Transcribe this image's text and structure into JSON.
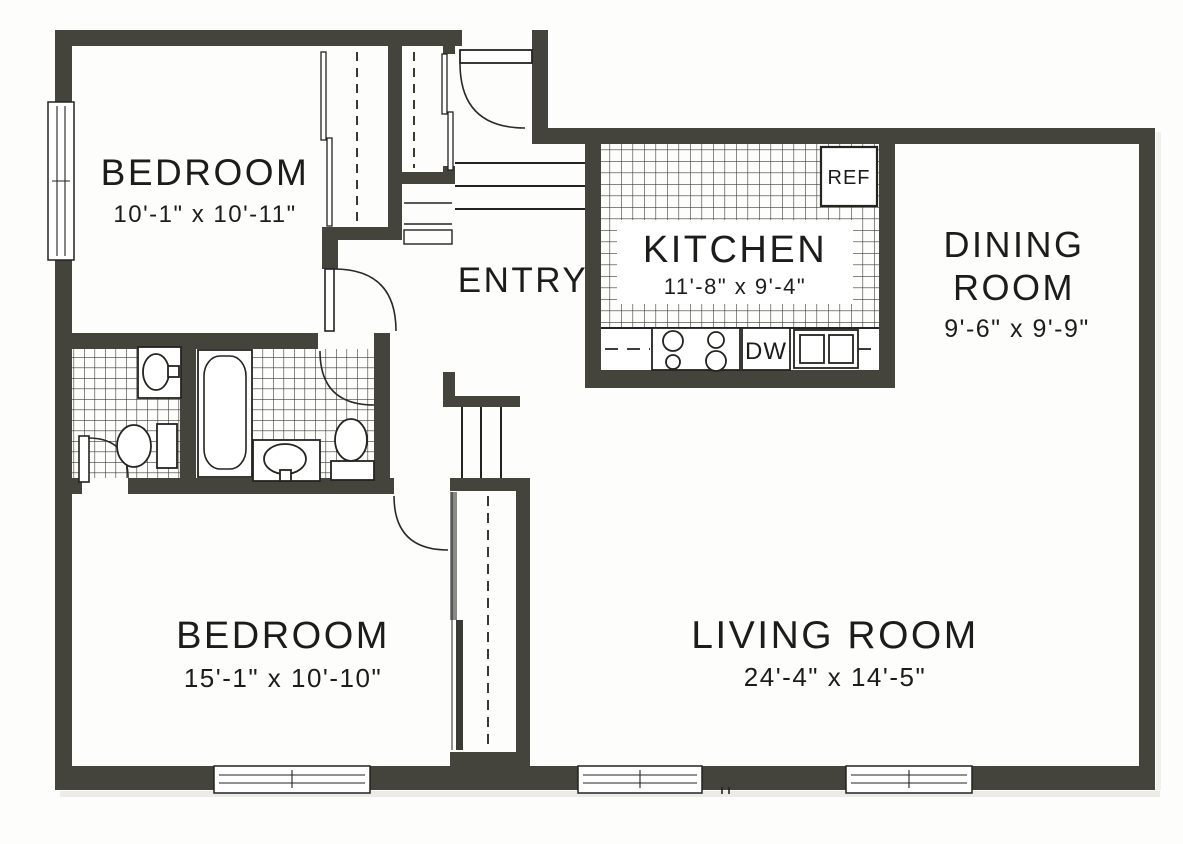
{
  "floor_plan": {
    "type": "residential apartment floor plan",
    "bedroom_1": {
      "label": "BEDROOM",
      "dimensions": "10'-1\" x 10'-11\""
    },
    "kitchen": {
      "label": "KITCHEN",
      "dimensions": "11'-8\" x 9'-4\""
    },
    "dining_room": {
      "label_line1": "DINING",
      "label_line2": "ROOM",
      "dimensions": "9'-6\" x 9'-9\""
    },
    "entry": {
      "label": "ENTRY"
    },
    "bedroom_2": {
      "label": "BEDROOM",
      "dimensions": "15'-1\" x 10'-10\""
    },
    "living_room": {
      "label": "LIVING ROOM",
      "dimensions": "24'-4\" x 14'-5\""
    },
    "appliances": {
      "refrigerator": "REF",
      "dishwasher": "DW"
    },
    "colors": {
      "wall": "#45443c",
      "line": "#23231f",
      "paper": "#fdfdfb"
    }
  }
}
